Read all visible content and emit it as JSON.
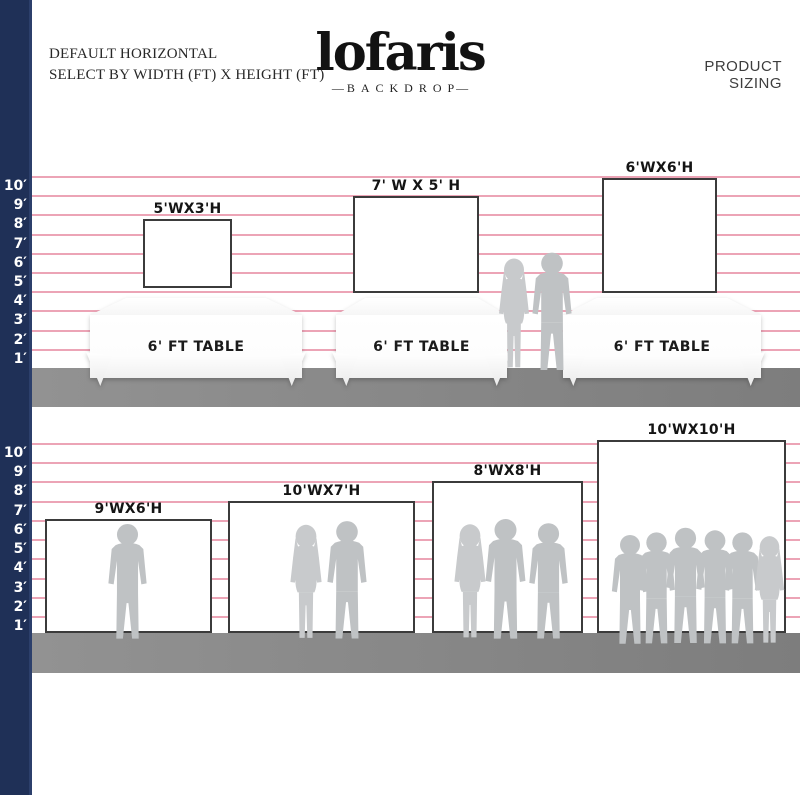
{
  "header": {
    "line1": "DEFAULT HORIZONTAL",
    "line2": "SELECT BY WIDTH (FT) X HEIGHT (FT)",
    "logo_text": "lofaris",
    "logo_sub": "BACKDROP",
    "product_sizing": "PRODUCT SIZING"
  },
  "colors": {
    "ruler_bar_navy": "#1f3057",
    "gridline_pink": "#eca4b6",
    "floor_gray": "#8a8a8a",
    "silhouette_gray": "#c2c4c6",
    "frame_border": "#3b3b3b"
  },
  "ruler_labels": [
    "10′",
    "9′",
    "8′",
    "7′",
    "6′",
    "5′",
    "4′",
    "3′",
    "2′",
    "1′"
  ],
  "top_section": {
    "backdrops": [
      {
        "label": "5'WX3'H"
      },
      {
        "label": "7' W X 5' H"
      },
      {
        "label": "6'WX6'H"
      }
    ],
    "tables": [
      {
        "label": "6' FT TABLE"
      },
      {
        "label": "6' FT TABLE"
      },
      {
        "label": "6' FT TABLE"
      }
    ]
  },
  "bottom_section": {
    "backdrops": [
      {
        "label": "9'WX6'H"
      },
      {
        "label": "10'WX7'H"
      },
      {
        "label": "8'WX8'H"
      },
      {
        "label": "10'WX10'H"
      }
    ]
  }
}
